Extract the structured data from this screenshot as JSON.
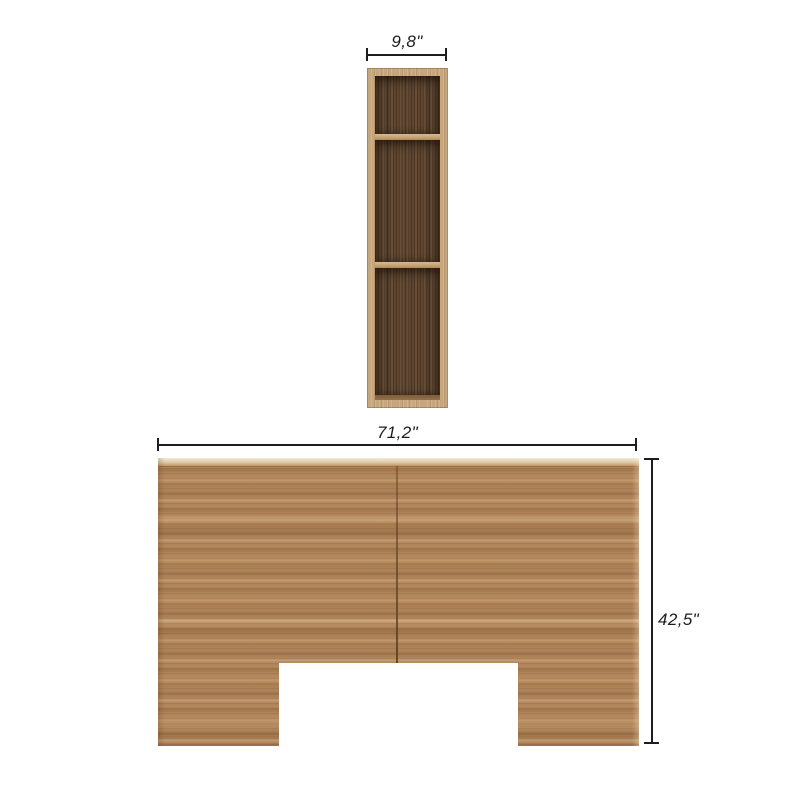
{
  "diagram": {
    "shelf": {
      "width_label": "9,8\""
    },
    "headboard": {
      "width_label": "71,2\"",
      "height_label": "42,5\""
    }
  },
  "colors": {
    "background": "#ffffff",
    "dimension": "#1d1d1d",
    "wood_frame": "#c6a77d",
    "wood_face": "#b2855a",
    "wood_interior": "#5d4530",
    "wood_top_edge": "#efe6d4"
  }
}
